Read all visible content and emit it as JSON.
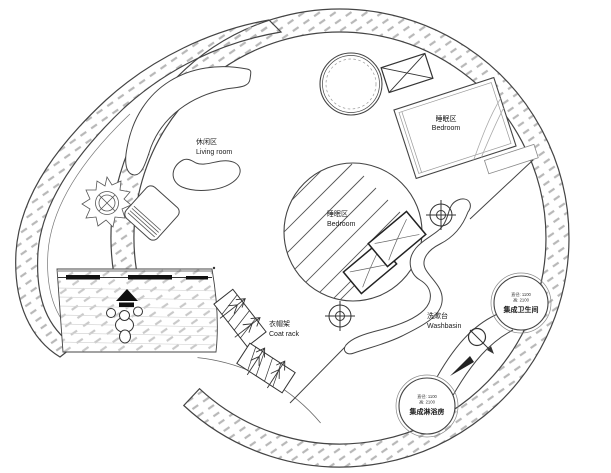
{
  "plan": {
    "type": "circular floor plan",
    "colors": {
      "line": "#444444",
      "dark": "#111111",
      "hatch": "#b8b8b8",
      "deck_hatch": "#c9c9c9",
      "text": "#1a1a1a",
      "background": "#ffffff"
    },
    "zones": {
      "living": {
        "zh": "休闲区",
        "en": "Living room"
      },
      "bedroom_upper": {
        "zh": "睡眠区",
        "en": "Bedroom"
      },
      "bedroom_center": {
        "zh": "睡眠区",
        "en": "Bedroom"
      },
      "coat_rack": {
        "zh": "衣帽架",
        "en": "Coat rack"
      },
      "washbasin": {
        "zh": "洗漱台",
        "en": "Washbasin"
      },
      "toilet_pod": {
        "name": "集成卫生间",
        "dim_diameter": "直径: 1100",
        "dim_height": "高: 2100"
      },
      "shower_pod": {
        "name": "集成淋浴房",
        "dim_diameter": "直径: 1100",
        "dim_height": "高: 2100"
      }
    },
    "symbols": [
      "spiral-outer-wall",
      "circular-wall-ring",
      "entry-deck",
      "sliding-door-track",
      "person-walking",
      "entry-direction-arrow",
      "curved-sofa",
      "side-table",
      "lounge-chair",
      "potted-plant",
      "round-table",
      "ac-unit",
      "double-bed",
      "bedroom-core-circle",
      "core-bed-cushions",
      "curtain-divider",
      "coat-rack-x2",
      "washbasin-counter",
      "faucet",
      "flow-arrow",
      "crosshair-marker-x2",
      "toilet-pod-circle",
      "shower-pod-circle"
    ]
  }
}
